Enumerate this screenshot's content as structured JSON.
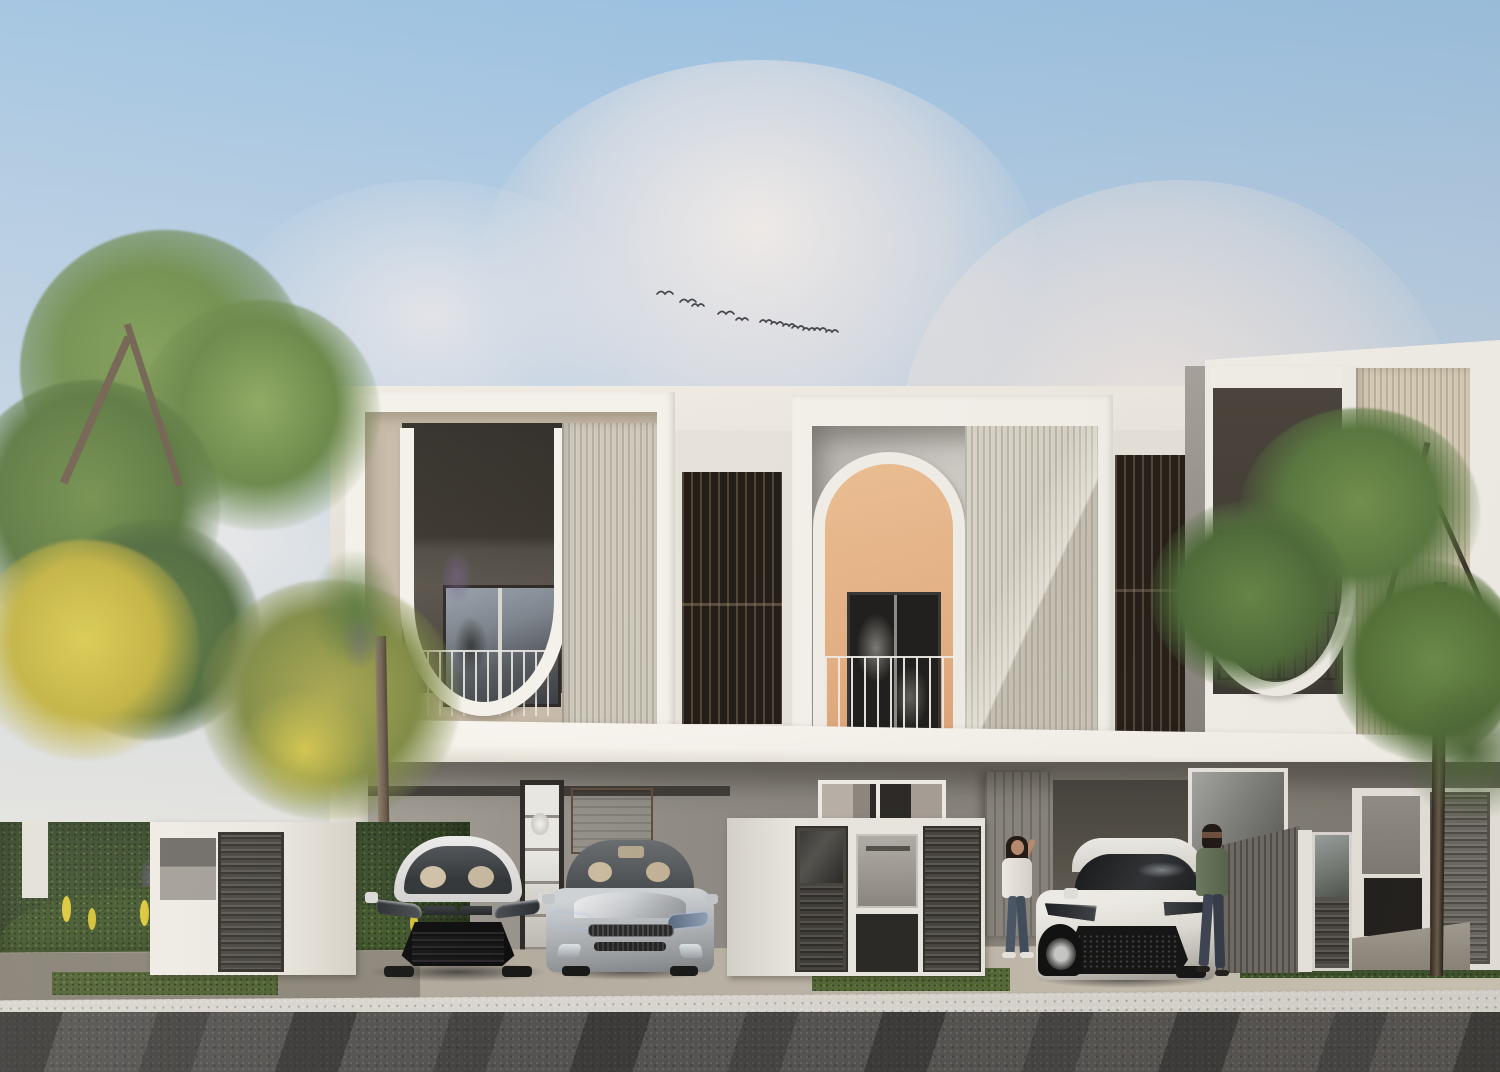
{
  "scene": {
    "type": "architectural-exterior-rendering",
    "description": "Row of three modern two-storey townhouses with arched and U-shaped white window frames, carports with parked cars, two women talking by a white hatchback, trees and hedge on the left, street in foreground, soft afternoon sky with a small flock of birds",
    "units": 3,
    "objects": [
      "sky",
      "clouds",
      "bird-flock",
      "left-tree",
      "yellow-blossom-tree",
      "hedge",
      "flower-bed",
      "townhouse-left",
      "townhouse-middle",
      "townhouse-right",
      "slat-screen-left",
      "slat-screen-right",
      "balcony-left",
      "arched-balcony-middle",
      "balcony-right",
      "fluted-texture-panels",
      "carport-left",
      "display-cabinet",
      "wood-panel",
      "ground-window",
      "wood-door",
      "white-sedan",
      "silver-hatchback",
      "white-sport-hatch",
      "utility-enclosure",
      "gate-fence-middle",
      "mailbox",
      "gate-right",
      "louver-shutter",
      "concrete-planter",
      "woman-waving",
      "woman-standing",
      "right-tree",
      "sidewalk",
      "grass-strips",
      "curb",
      "asphalt-road",
      "tree-shadows"
    ]
  },
  "counts": {
    "birds": 12,
    "cars": 3,
    "people": 2,
    "townhouse_units": 3
  },
  "cars": [
    {
      "name": "white-sedan",
      "color": "#eeedec"
    },
    {
      "name": "silver-hatchback",
      "color": "#b6b9bc"
    },
    {
      "name": "white-sport-hatch",
      "color": "#edebe6"
    }
  ],
  "people": [
    {
      "name": "woman-waving",
      "top_color": "#ece8e2",
      "pants_color": "#4b5666"
    },
    {
      "name": "woman-standing",
      "top_color": "#65705a",
      "pants_color": "#3d4452"
    }
  ],
  "palette": {
    "sky-top": "#9cc1e0",
    "sky-mid": "#c6d5e3",
    "sky-low": "#e6e4de",
    "cloud": "#efe8e4",
    "white-hi": "#f4f1eb",
    "white-lo": "#e7e3db",
    "beige-reveal": "#c8baa8",
    "window-dark": "#37332e",
    "window-mid": "#57524b",
    "glass-blue": "#8b949e",
    "texture-light": "#cfc9bc",
    "texture-beige": "#d9ceb8",
    "slat-dark": "#241e19",
    "peach": "#e6b286",
    "arch-door": "#211f1d",
    "gray-wall": "#908c85",
    "carport": "#686460",
    "slab": "#f5f2ec",
    "fence-white": "#eae7e0",
    "louver-gray": "#48453f",
    "mailbox": "#a19d96",
    "wood": "#8a7257",
    "sidewalk": "#b4ac9f",
    "curb": "#d8d5ce",
    "road": "#555351",
    "grass": "#4f6234",
    "hedge": "#3f5130",
    "leaf": "#6d8c4a",
    "leaf-dark": "#55713c",
    "leaf-lite": "#86a35b",
    "blossom": "#d2c144",
    "trunk": "#816f5b",
    "skin": "#b98a6e"
  }
}
